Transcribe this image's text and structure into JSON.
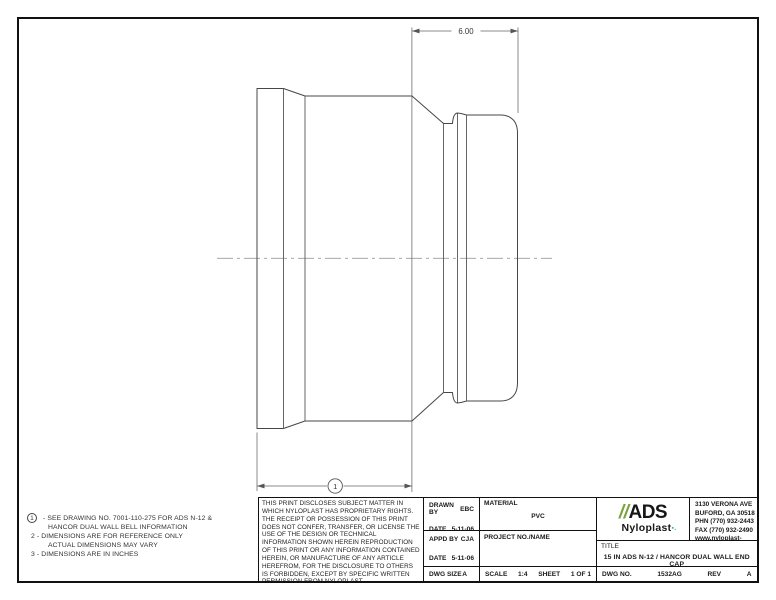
{
  "drawing": {
    "dim_top": "6.00",
    "balloon_label": "1"
  },
  "notes": {
    "balloon1": "1",
    "item1a": "-  SEE DRAWING NO. 7001-110-275 FOR ADS N-12 &",
    "item1b": "HANCOR DUAL WALL BELL INFORMATION",
    "item2a": "2  -  DIMENSIONS ARE FOR REFERENCE ONLY",
    "item2b": "ACTUAL DIMENSIONS MAY VARY",
    "item3": "3  -  DIMENSIONS ARE IN INCHES"
  },
  "title_block": {
    "disclaimer": "THIS PRINT DISCLOSES SUBJECT MATTER IN WHICH NYLOPLAST HAS PROPRIETARY RIGHTS.  THE RECEIPT OR POSSESSION OF THIS PRINT DOES NOT CONFER, TRANSFER, OR LICENSE THE USE OF THE DESIGN OR TECHNICAL INFORMATION SHOWN HEREIN REPRODUCTION OF THIS PRINT OR ANY INFORMATION CONTAINED HEREIN, OR MANUFACTURE OF ANY ARTICLE HEREFROM, FOR THE DISCLOSURE TO OTHERS IS FORBIDDEN, EXCEPT BY SPECIFIC WRITTEN PERMISSION FROM NYLOPLAST.",
    "drawn_by_label": "DRAWN BY",
    "drawn_by": "EBC",
    "date1_label": "DATE",
    "date1": "5-11-06",
    "appd_by_label": "APPD BY",
    "appd_by": "CJA",
    "date2_label": "DATE",
    "date2": "5-11-06",
    "material_label": "MATERIAL",
    "material": "PVC",
    "project_label": "PROJECT NO./NAME",
    "dwg_size_label": "DWG SIZE",
    "dwg_size": "A",
    "scale_label": "SCALE",
    "scale": "1:4",
    "sheet_label": "SHEET",
    "sheet": "1 OF 1",
    "title_label": "TITLE",
    "title": "15 IN ADS N-12 / HANCOR DUAL WALL END CAP",
    "dwg_no_label": "DWG NO.",
    "dwg_no": "1532AG",
    "rev_label": "REV",
    "rev": "A"
  },
  "company": {
    "logo_slashes": "//",
    "logo_name": "ADS",
    "logo_sub": "Nyloplast",
    "logo_mark": "▪.",
    "accent_green": "#76a33e",
    "accent_teal": "#3fae9c",
    "address1": "3130 VERONA AVE",
    "address2": "BUFORD, GA 30518",
    "phone": "PHN (770) 932-2443",
    "fax": "FAX (770) 932-2490",
    "website": "www.nyloplast-us.com"
  }
}
